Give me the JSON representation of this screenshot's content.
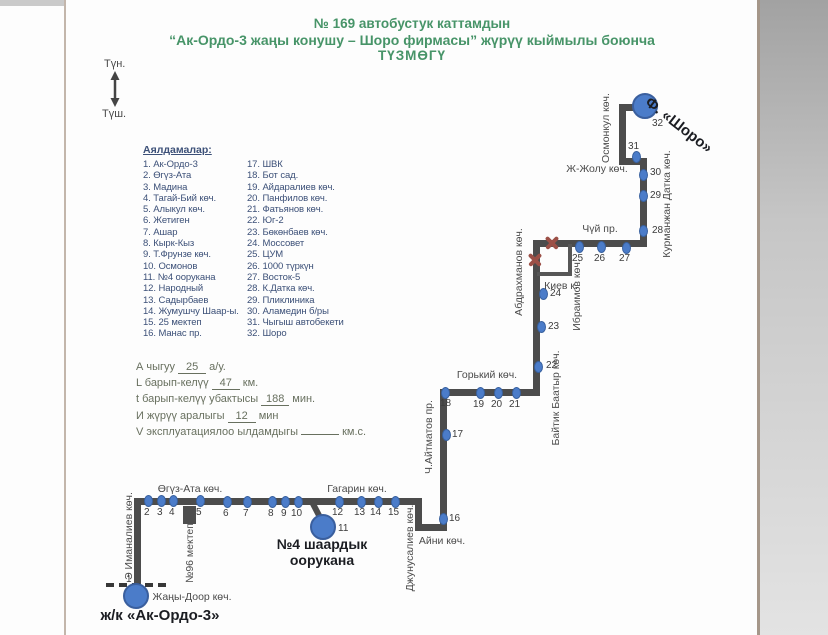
{
  "title": {
    "line1": "№ 169  автобустук каттамдын",
    "line2": "“Ак-Ордо-3 жаңы конушу  – Шоро фирмасы” жүрүү кыймылы боюнча",
    "line3": "ТҮЗМӨГҮ"
  },
  "compass": {
    "north": "Түн.",
    "south": "Түш."
  },
  "legend": {
    "header": "Аялдамалар:",
    "col1": [
      "1. Ак-Ордо-3",
      "2. Өгүз-Ата",
      "3. Мадина",
      "4. Тагай-Бий көч.",
      "5. Алыкул көч.",
      "6. Жетиген",
      "7. Ашар",
      "8. Кырк-Кыз",
      "9. Т.Фрунзе көч.",
      "10. Осмонов",
      "11. №4 оорукана",
      "12. Народный",
      "13. Садырбаев",
      "14. Жумушчу Шаар-ы.",
      "15. 25 мектеп",
      "16. Манас пр."
    ],
    "col2": [
      "17. ШВК",
      "18. Бот сад.",
      "19. Айдаралиев көч.",
      "20. Панфилов көч.",
      "21. Фатьянов көч.",
      "22. Юг-2",
      "23. Бөкөнбаев көч.",
      "24. Моссовет",
      "25. ЦУМ",
      "26. 1000 түркүн",
      "27. Восток-5",
      "28. К.Датка көч.",
      "29. Пликлиника",
      "30. Аламедин б/ры",
      "31. Чыгыш автобекети",
      "32. Шоро"
    ]
  },
  "stats": {
    "lines": [
      {
        "prefix": "А чыгуу",
        "value": "25",
        "suffix": "а/у."
      },
      {
        "prefix": "L барып-келүү",
        "value": "47",
        "suffix": "км."
      },
      {
        "prefix": "t барып-келүү убактысы",
        "value": "188",
        "suffix": "мин."
      },
      {
        "prefix": "И жүрүү аралыгы",
        "value": "12",
        "suffix": "мин"
      },
      {
        "prefix": "V эксплуатациялоо ылдамдыгы",
        "value": "",
        "suffix": "км.с."
      }
    ]
  },
  "map": {
    "terminus_start": "ж/к «Ак-Ордо-3»",
    "terminus_end": "Ф. «Шоро»",
    "hospital_line1": "№4 шаардык",
    "hospital_line2": "оорукана",
    "colors": {
      "route": "#4c4c4c",
      "stop_dot": "#4b7cc9",
      "closed_mark": "#9c5047",
      "title_green": "#479468",
      "legend_blue": "#3c5078"
    },
    "stops": [
      {
        "n": "1",
        "x": 136,
        "y": 596,
        "big": true,
        "lx": 126,
        "ly": 574
      },
      {
        "n": "2",
        "x": 148,
        "y": 501,
        "lx": 144,
        "ly": 507
      },
      {
        "n": "3",
        "x": 161,
        "y": 501,
        "lx": 157,
        "ly": 507
      },
      {
        "n": "4",
        "x": 173,
        "y": 501,
        "lx": 169,
        "ly": 507
      },
      {
        "n": "5",
        "x": 200,
        "y": 501,
        "lx": 196,
        "ly": 507
      },
      {
        "n": "6",
        "x": 227,
        "y": 502,
        "lx": 223,
        "ly": 508
      },
      {
        "n": "7",
        "x": 247,
        "y": 502,
        "lx": 243,
        "ly": 508
      },
      {
        "n": "8",
        "x": 272,
        "y": 502,
        "lx": 268,
        "ly": 508
      },
      {
        "n": "9",
        "x": 285,
        "y": 502,
        "lx": 281,
        "ly": 508
      },
      {
        "n": "10",
        "x": 298,
        "y": 502,
        "lx": 291,
        "ly": 508
      },
      {
        "n": "11",
        "x": 323,
        "y": 527,
        "big": true,
        "lx": 338,
        "ly": 523
      },
      {
        "n": "12",
        "x": 339,
        "y": 502,
        "lx": 332,
        "ly": 507
      },
      {
        "n": "13",
        "x": 361,
        "y": 502,
        "lx": 354,
        "ly": 507
      },
      {
        "n": "14",
        "x": 378,
        "y": 502,
        "lx": 370,
        "ly": 507
      },
      {
        "n": "15",
        "x": 395,
        "y": 502,
        "lx": 388,
        "ly": 507
      },
      {
        "n": "16",
        "x": 443,
        "y": 519,
        "lx": 449,
        "ly": 513
      },
      {
        "n": "17",
        "x": 446,
        "y": 435,
        "lx": 452,
        "ly": 429
      },
      {
        "n": "18",
        "x": 445,
        "y": 393,
        "lx": 440,
        "ly": 398
      },
      {
        "n": "19",
        "x": 480,
        "y": 393,
        "lx": 473,
        "ly": 399
      },
      {
        "n": "20",
        "x": 498,
        "y": 393,
        "lx": 491,
        "ly": 399
      },
      {
        "n": "21",
        "x": 516,
        "y": 393,
        "lx": 509,
        "ly": 399
      },
      {
        "n": "22",
        "x": 538,
        "y": 367,
        "lx": 546,
        "ly": 360
      },
      {
        "n": "23",
        "x": 541,
        "y": 327,
        "lx": 548,
        "ly": 321
      },
      {
        "n": "24",
        "x": 543,
        "y": 294,
        "lx": 550,
        "ly": 288
      },
      {
        "n": "25",
        "x": 579,
        "y": 247,
        "lx": 572,
        "ly": 253
      },
      {
        "n": "26",
        "x": 601,
        "y": 247,
        "lx": 594,
        "ly": 253
      },
      {
        "n": "27",
        "x": 626,
        "y": 248,
        "lx": 619,
        "ly": 253
      },
      {
        "n": "28",
        "x": 643,
        "y": 231,
        "lx": 652,
        "ly": 225
      },
      {
        "n": "29",
        "x": 643,
        "y": 196,
        "lx": 650,
        "ly": 190
      },
      {
        "n": "30",
        "x": 643,
        "y": 175,
        "lx": 650,
        "ly": 167
      },
      {
        "n": "31",
        "x": 636,
        "y": 157,
        "lx": 628,
        "ly": 141
      },
      {
        "n": "32",
        "x": 645,
        "y": 106,
        "big": true,
        "lx": 652,
        "ly": 118
      }
    ],
    "streets": [
      {
        "text": "Өгүз-Ата көч.",
        "x": 190,
        "y": 489,
        "rot": 0
      },
      {
        "text": "Гагарин көч.",
        "x": 357,
        "y": 489,
        "rot": 0
      },
      {
        "text": "Жаңы-Доор көч.",
        "x": 192,
        "y": 597,
        "rot": 0
      },
      {
        "text": "Айни көч.",
        "x": 442,
        "y": 541,
        "rot": 0
      },
      {
        "text": "Горький көч.",
        "x": 487,
        "y": 375,
        "rot": 0
      },
      {
        "text": "Киев к.",
        "x": 561,
        "y": 286,
        "rot": 0
      },
      {
        "text": "Чүй пр.",
        "x": 600,
        "y": 229,
        "rot": 0
      },
      {
        "text": "Ж-Жолу көч.",
        "x": 597,
        "y": 169,
        "rot": 0
      },
      {
        "text": "Э Иманалиев көч.",
        "x": 129,
        "y": 536,
        "rot": -90
      },
      {
        "text": "№96 мектеп",
        "x": 190,
        "y": 553,
        "rot": -90
      },
      {
        "text": "Джунусалиев көч.",
        "x": 410,
        "y": 548,
        "rot": -90
      },
      {
        "text": "Ч.Айтматов пр.",
        "x": 429,
        "y": 437,
        "rot": -90
      },
      {
        "text": "Байтик Баатыр көч.",
        "x": 556,
        "y": 398,
        "rot": -90
      },
      {
        "text": "Абдрахманов көч.",
        "x": 519,
        "y": 272,
        "rot": -90
      },
      {
        "text": "Ибраимов көч.",
        "x": 577,
        "y": 295,
        "rot": -90
      },
      {
        "text": "Курманжан Датка көч.",
        "x": 667,
        "y": 204,
        "rot": -90
      },
      {
        "text": "Осмонкул көч.",
        "x": 606,
        "y": 128,
        "rot": -90
      }
    ],
    "closed_marks": [
      {
        "x": 552,
        "y": 243
      },
      {
        "x": 535,
        "y": 260
      }
    ]
  }
}
